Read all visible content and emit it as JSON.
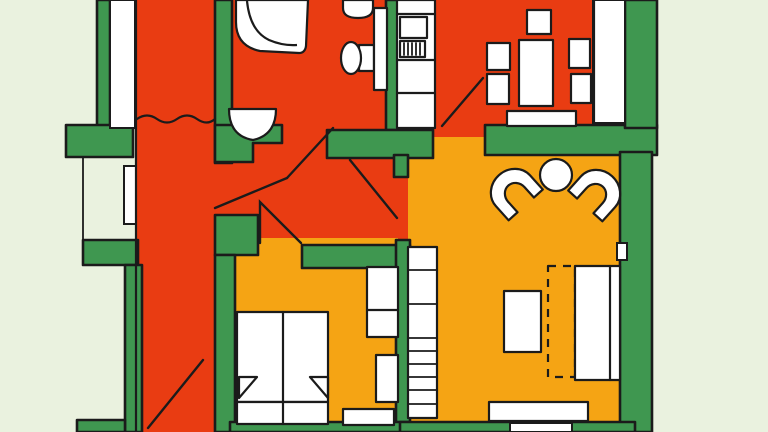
{
  "colors": {
    "room_red": "#e93c12",
    "room_orange": "#f5a414",
    "wall_green": "#3f9750",
    "exterior_pale": "#eaf2df",
    "fixture_white": "#ffffff",
    "outline": "#1b1b1b"
  },
  "plan": {
    "type": "apartment-floor-plan",
    "rooms": [
      {
        "name": "stairwell",
        "floor_color": "room_red"
      },
      {
        "name": "bathroom",
        "floor_color": "room_red"
      },
      {
        "name": "kitchen-dining",
        "floor_color": "room_red"
      },
      {
        "name": "hallway",
        "floor_color": "room_red"
      },
      {
        "name": "bedroom",
        "floor_color": "room_orange"
      },
      {
        "name": "living-room",
        "floor_color": "room_orange"
      }
    ],
    "fixtures": [
      "corner-bathtub",
      "washbasin",
      "toilet",
      "small-sink",
      "kitchen-counter",
      "fridge",
      "cooktop",
      "dining-table",
      "dining-chairs",
      "dining-bench",
      "armchair-left",
      "armchair-right",
      "side-table",
      "shelving-unit",
      "coffee-table",
      "sofa",
      "fold-out-bed",
      "sideboard",
      "double-bed",
      "pillows",
      "wardrobe",
      "wardrobe-lower",
      "dresser"
    ],
    "doors": [
      "entry-door",
      "bathroom-door",
      "kitchen-door",
      "dining-door",
      "bedroom-door"
    ],
    "annotations": [
      "stair-break-line",
      "stair-diagonal"
    ]
  }
}
